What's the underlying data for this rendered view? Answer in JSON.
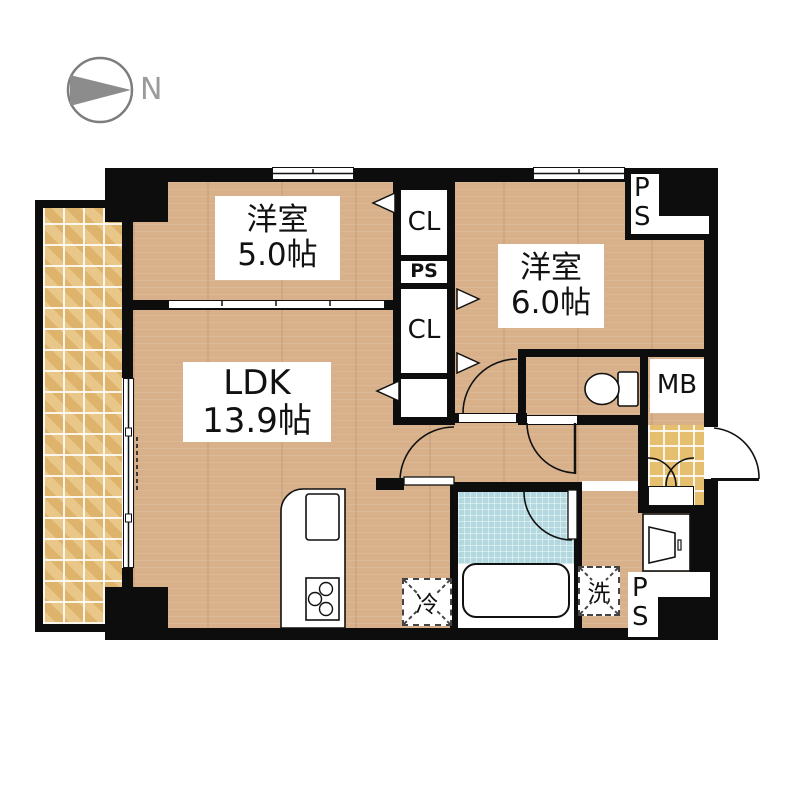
{
  "meta": {
    "type": "apartment-floor-plan"
  },
  "compass": {
    "north_label": "N"
  },
  "rooms": [
    {
      "id": "bedroom1",
      "name": "洋室",
      "size": "5.0帖"
    },
    {
      "id": "bedroom2",
      "name": "洋室",
      "size": "6.0帖"
    },
    {
      "id": "ldk",
      "name": "LDK",
      "size": "13.9帖"
    }
  ],
  "fixtures": {
    "closet_top": "CL",
    "pipe_space_mid": "PS",
    "closet_mid": "CL",
    "meter_box": "MB",
    "refrigerator": "冷",
    "washing_machine": "洗",
    "pipe_space_top_right": {
      "line1": "P",
      "line2": "S"
    },
    "pipe_space_bottom_right": {
      "line1": "P",
      "line2": "S"
    }
  },
  "colors": {
    "wall": "#0d0d0d",
    "wood_floor": "#d8b18a",
    "balcony_tile": "#e2b973",
    "entrance_tile": "#e6bf6e",
    "bathroom": "#b3d8df",
    "compass_gray": "#8c8c8c"
  }
}
